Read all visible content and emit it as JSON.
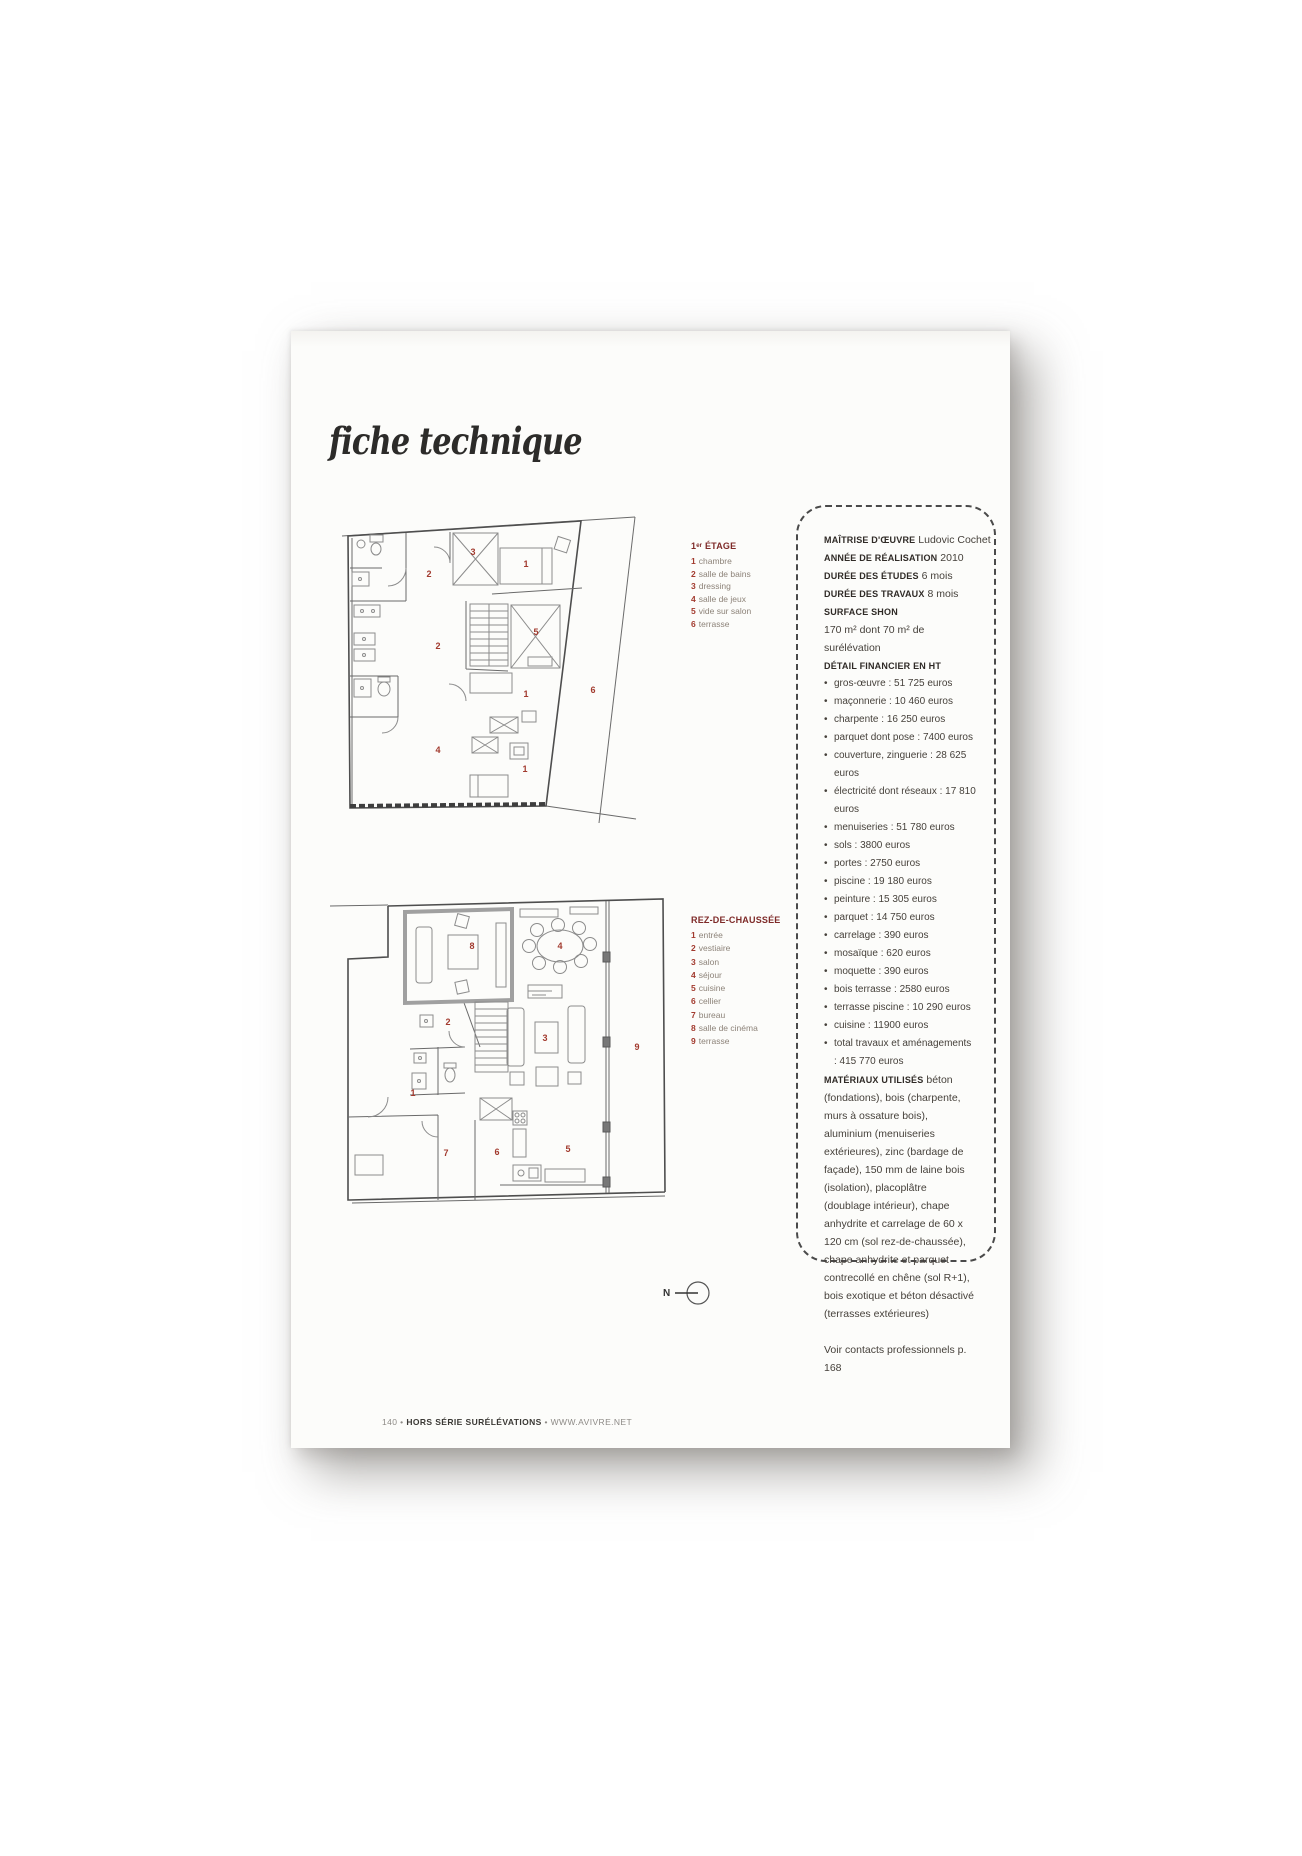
{
  "page": {
    "title": "fiche technique",
    "north_label": "N",
    "footer": {
      "page_number": "140",
      "separator": "•",
      "magazine": "HORS SÉRIE SURÉLÉVATIONS",
      "website": "WWW.AVIVRE.NET"
    }
  },
  "legend_floor1": {
    "heading": "1ᵉʳ ÉTAGE",
    "items": [
      {
        "num": "1",
        "label": "chambre"
      },
      {
        "num": "2",
        "label": "salle de bains"
      },
      {
        "num": "3",
        "label": "dressing"
      },
      {
        "num": "4",
        "label": "salle de jeux"
      },
      {
        "num": "5",
        "label": "vide sur salon"
      },
      {
        "num": "6",
        "label": "terrasse"
      }
    ]
  },
  "legend_ground": {
    "heading": "REZ-DE-CHAUSSÉE",
    "items": [
      {
        "num": "1",
        "label": "entrée"
      },
      {
        "num": "2",
        "label": "vestiaire"
      },
      {
        "num": "3",
        "label": "salon"
      },
      {
        "num": "4",
        "label": "séjour"
      },
      {
        "num": "5",
        "label": "cuisine"
      },
      {
        "num": "6",
        "label": "cellier"
      },
      {
        "num": "7",
        "label": "bureau"
      },
      {
        "num": "8",
        "label": "salle de cinéma"
      },
      {
        "num": "9",
        "label": "terrasse"
      }
    ]
  },
  "infobox": {
    "meta": [
      {
        "label": "MAÎTRISE D'ŒUVRE",
        "value": "Ludovic Cochet"
      },
      {
        "label": "ANNÉE DE RÉALISATION",
        "value": "2010"
      },
      {
        "label": "DURÉE DES ÉTUDES",
        "value": "6 mois"
      },
      {
        "label": "DURÉE DES TRAVAUX",
        "value": "8 mois"
      },
      {
        "label": "SURFACE SHON",
        "value": ""
      }
    ],
    "surface_line": "170 m² dont 70 m² de surélévation",
    "financial_heading": "DÉTAIL FINANCIER EN HT",
    "costs": [
      "gros-œuvre : 51 725 euros",
      "maçonnerie : 10 460 euros",
      "charpente : 16 250 euros",
      "parquet dont pose : 7400 euros",
      "couverture, zinguerie : 28 625 euros",
      "électricité dont réseaux : 17 810 euros",
      "menuiseries : 51 780 euros",
      "sols : 3800 euros",
      "portes : 2750 euros",
      "piscine : 19 180 euros",
      "peinture : 15 305 euros",
      "parquet : 14 750 euros",
      "carrelage : 390 euros",
      "mosaïque : 620 euros",
      "moquette : 390 euros",
      "bois terrasse : 2580 euros",
      "terrasse piscine : 10 290 euros",
      "cuisine : 11900 euros",
      "total travaux et aménagements : 415 770 euros"
    ],
    "materials_label": "MATÉRIAUX UTILISÉS",
    "materials_text": "béton (fondations), bois (charpente, murs à ossature bois), aluminium (menuiseries extérieures), zinc (bardage de façade), 150 mm de laine bois (isolation), placoplâtre (doublage intérieur), chape anhydrite et carrelage de 60 x 120 cm (sol rez-de-chaussée), chape anhydrite et parquet contrecollé en chêne (sol R+1), bois exotique et béton désactivé (terrasses extérieures)",
    "contacts_note": "Voir contacts professionnels p. 168"
  },
  "plan_floor1": {
    "markers": [
      "3",
      "1",
      "2",
      "5",
      "2",
      "1",
      "6",
      "4",
      "1"
    ]
  },
  "plan_ground": {
    "markers": [
      "8",
      "4",
      "2",
      "3",
      "1",
      "7",
      "6",
      "5",
      "9"
    ]
  },
  "colors": {
    "accent_red": "#a23a2e",
    "heading_red": "#7e2a28"
  }
}
